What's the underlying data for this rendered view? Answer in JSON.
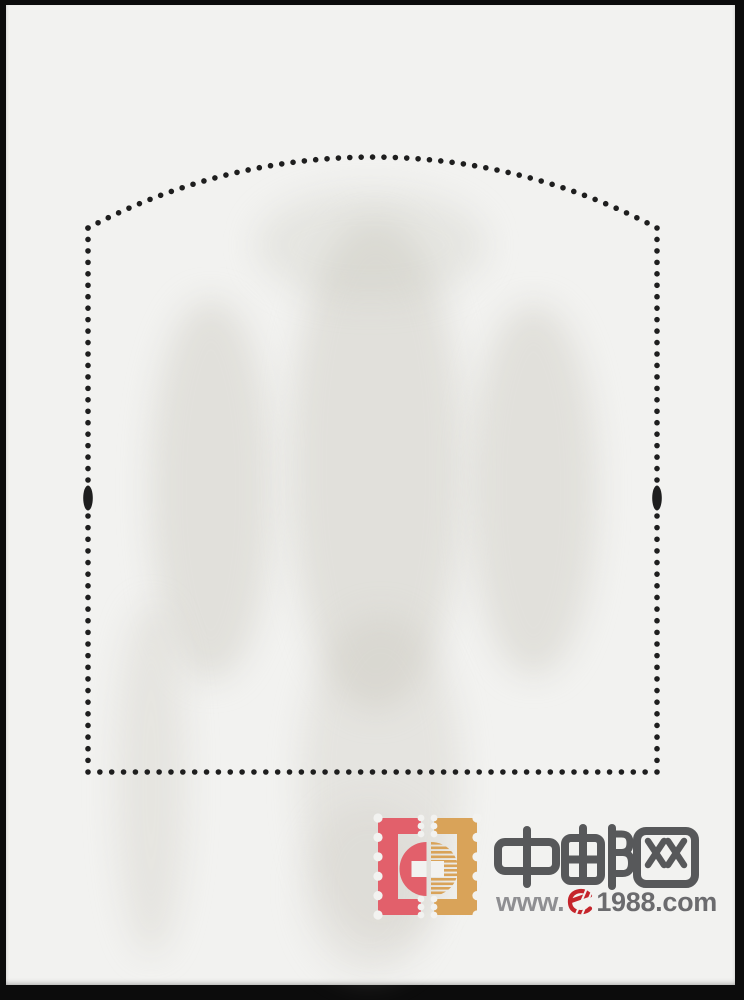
{
  "image": {
    "type": "scanned souvenir-sheet back with arched perforation outline",
    "paper_color": "#f2f2f0",
    "scan_background_color": "#0c0c0c",
    "perforation_dot_color": "#1e1e1e",
    "registration_marks": "elongated oval at mid-height on left and right perforation columns"
  },
  "watermark": {
    "site_name": "中邮网",
    "url_prefix": "www.",
    "url_symbol": "e",
    "url_suffix": "1988.com",
    "url_full": "www.e1988.com",
    "colors": {
      "stamp_pink": "#e2606b",
      "stamp_tan": "#d9a359",
      "brand_red": "#c5242b",
      "cjk_gray": "#57585a",
      "www_gray": "#8f8f92",
      "domain_gray": "#6b6b6e"
    }
  }
}
